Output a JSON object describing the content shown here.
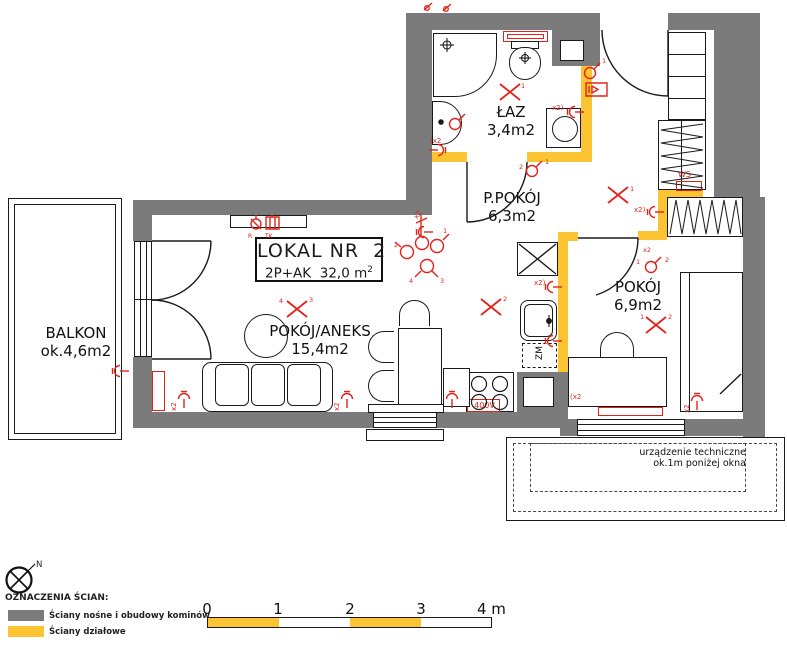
{
  "plan": {
    "title_box": {
      "line1": "LOKAL NR  2",
      "line2": "2P+AK  32,0 m",
      "sup": "2"
    },
    "rooms": {
      "balkon": {
        "name": "BALKON",
        "area": "ok.4,6m2"
      },
      "laz": {
        "name": "ŁAZ",
        "area": "3,4m2"
      },
      "ppokoj": {
        "name": "P.POKÓJ",
        "area": "6,3m2"
      },
      "aneks": {
        "name": "POKÓJ/ANEKS",
        "area": "15,4m2"
      },
      "pokoj": {
        "name": "POKÓJ",
        "area": "6,9m2"
      }
    },
    "tech_note": {
      "line1": "urządzenie techniczne",
      "line2": "ok.1m poniżej okna"
    },
    "markers": {
      "x2": "x2",
      "x2o": "x2)",
      "x2c": "(x2",
      "ws": "WS",
      "zm": "ZM",
      "v400": "400V",
      "r": "R",
      "tk": "TK",
      "n1": "1",
      "n2": "2",
      "n3": "3",
      "n4": "4"
    }
  },
  "legend": {
    "north": "N",
    "heading": "OZNACZENIA ŚCIAN:",
    "items": [
      {
        "label": "Ściany nośne i obudowy kominów",
        "color": "#7b7b7b"
      },
      {
        "label": "Ściany działowe",
        "color": "#fcc433"
      }
    ]
  },
  "scalebar": {
    "ticks": [
      "0",
      "1",
      "2",
      "3"
    ],
    "end": "4 m"
  },
  "colors": {
    "wall_structural": "#7b7b7b",
    "wall_partition": "#fcc433",
    "symbol_red": "#e2231a"
  }
}
